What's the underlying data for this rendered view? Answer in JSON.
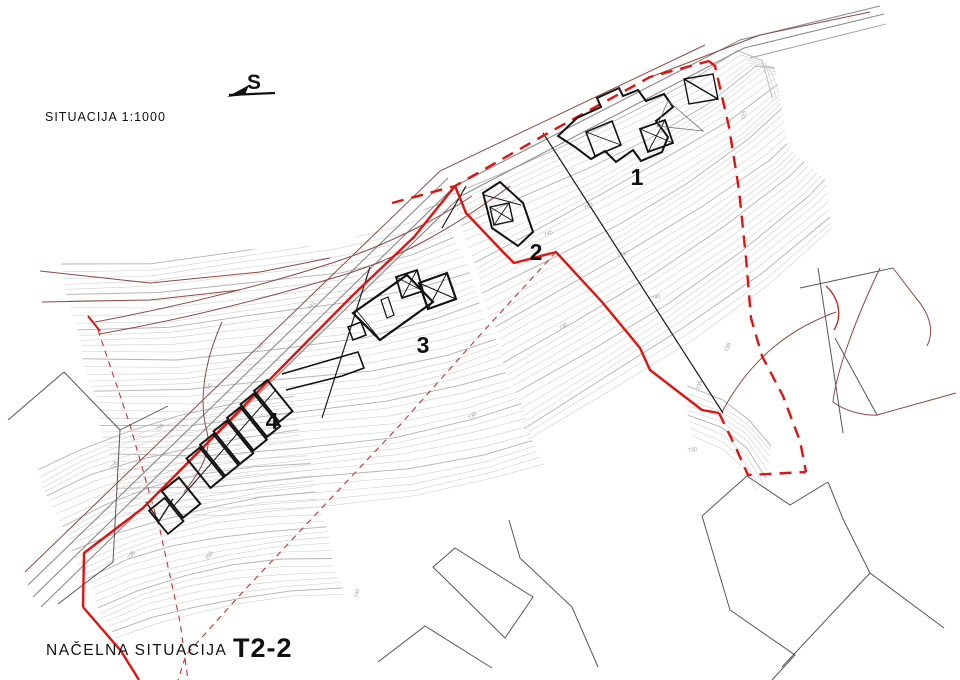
{
  "header": {
    "north_label": "S",
    "scale_label": "SITUACIJA 1:1000"
  },
  "footer": {
    "title_label": "NAČELNA SITUACIJA",
    "title_code": "T2-2"
  },
  "plan": {
    "building_labels": [
      {
        "label": "1"
      },
      {
        "label": "2"
      },
      {
        "label": "3"
      },
      {
        "label": "4"
      }
    ],
    "contour_elevations": [
      "750",
      "745",
      "741",
      "740",
      "736",
      "735",
      "730",
      "725",
      "755"
    ],
    "colors": {
      "boundary_red": "#de1410",
      "boundary_red_thin": "#c4342e",
      "existing_road_brown": "#8f4a44",
      "contour_gray": "#cccccc",
      "contour_index_gray": "#b2b2b2",
      "road_gray": "#8a8a8a",
      "parcel_gray": "#565656",
      "parcel_black": "#1b1b1b",
      "building_black": "#121212"
    }
  }
}
